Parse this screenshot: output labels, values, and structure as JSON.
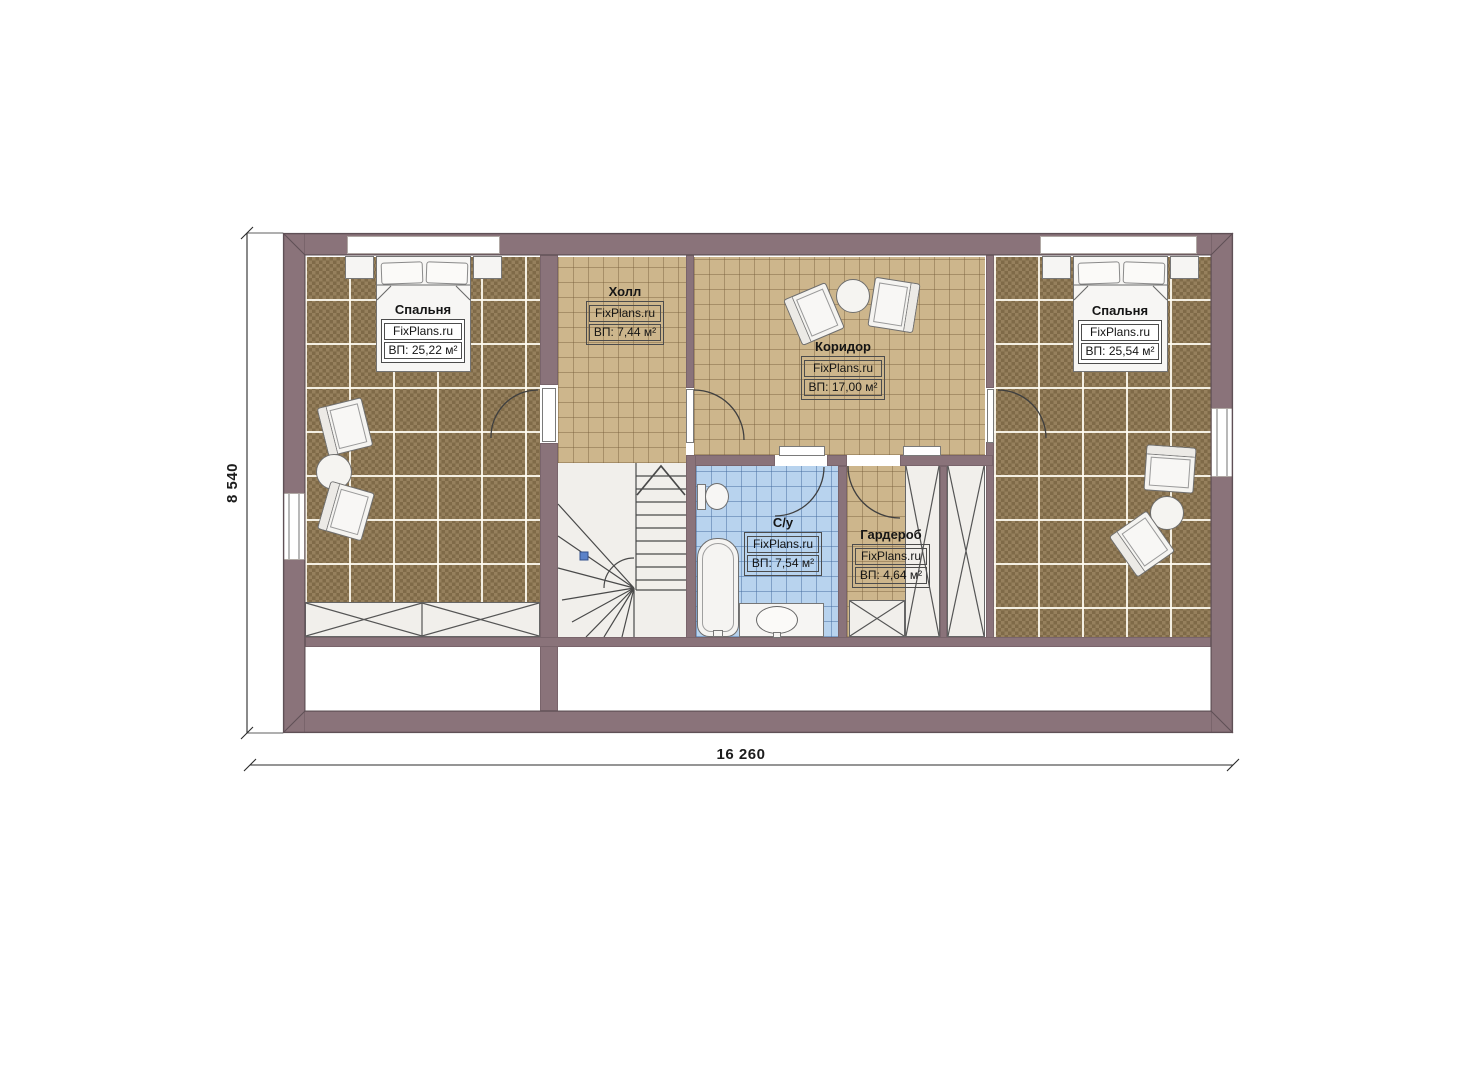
{
  "plan": {
    "watermark": "FixPlans.ru",
    "dimensions": {
      "width": "16 260",
      "height": "8 540"
    },
    "rooms": [
      {
        "id": "bedroom-left",
        "name": "Спальня",
        "area": "ВП: 25,22 м²"
      },
      {
        "id": "hall",
        "name": "Холл",
        "area": "ВП: 7,44 м²"
      },
      {
        "id": "corridor",
        "name": "Коридор",
        "area": "ВП: 17,00 м²"
      },
      {
        "id": "bedroom-right",
        "name": "Спальня",
        "area": "ВП: 25,54 м²"
      },
      {
        "id": "bathroom",
        "name": "С/у",
        "area": "ВП: 7,54 м²"
      },
      {
        "id": "wardrobe",
        "name": "Гардероб",
        "area": "ВП: 4,64 м²"
      }
    ],
    "colors": {
      "wall": "#8a737a",
      "bedroom_floor": "#8a7450",
      "hall_floor": "#cdb68c",
      "bathroom_floor": "#b8d3ee",
      "stair_marker": "#5b82c9"
    }
  }
}
